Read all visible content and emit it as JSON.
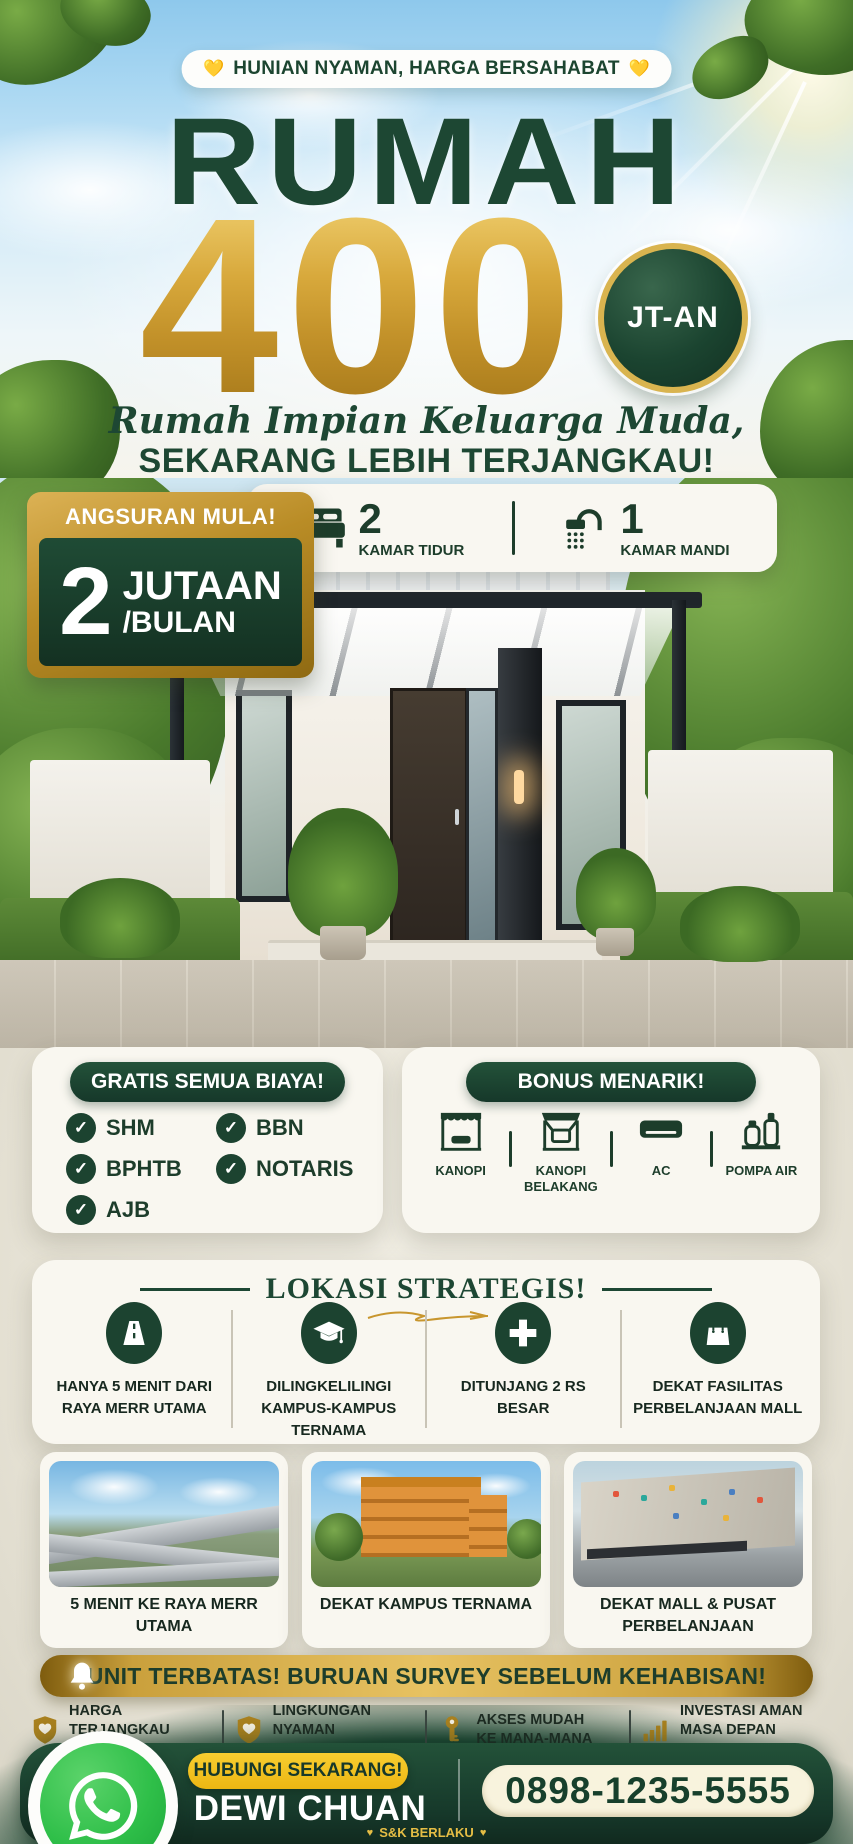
{
  "colors": {
    "dark_green": "#1c4330",
    "gold": "#c8962e",
    "gold_light": "#e7c262",
    "yellow_cta": "#f6c21a",
    "whatsapp_green": "#2fbf49",
    "cream_card": "#f9f7f0",
    "phone_pill": "#f8f3dd"
  },
  "icons": {
    "badge_heart": "💛",
    "terms_heart": "♥"
  },
  "header": {
    "heart": "💛",
    "badge": "HUNIAN NYAMAN, HARGA BERSAHABAT",
    "title": "RUMAH",
    "price": "400",
    "price_badge": "JT-AN",
    "script_line": "Rumah Impian Keluarga Muda,",
    "subline": "SEKARANG LEBIH TERJANGKAU!"
  },
  "installment": {
    "label": "ANGSURAN MULA!",
    "amount": "2",
    "unit": "JUTAAN",
    "per": "/BULAN"
  },
  "specs": {
    "bedrooms": {
      "count": "2",
      "label": "KAMAR TIDUR"
    },
    "bathrooms": {
      "count": "1",
      "label": "KAMAR MANDI"
    }
  },
  "gratis": {
    "title": "GRATIS SEMUA BIAYA!",
    "items": [
      "SHM",
      "BPHTB",
      "AJB",
      "BBN",
      "NOTARIS"
    ]
  },
  "bonus": {
    "title": "BONUS MENARIK!",
    "items": [
      "KANOPI",
      "KANOPI BELAKANG",
      "AC",
      "POMPA AIR"
    ]
  },
  "location": {
    "title": "LOKASI STRATEGIS!",
    "points": [
      "HANYA 5 MENIT DARI RAYA MERR UTAMA",
      "DILINGKELILINGI KAMPUS-KAMPUS TERNAMA",
      "DITUNJANG 2 RS BESAR",
      "DEKAT FASILITAS PERBELANJAAN MALL"
    ],
    "photo_captions": [
      "5 MENIT KE RAYA MERR UTAMA",
      "DEKAT KAMPUS TERNAMA",
      "DEKAT MALL & PUSAT PERBELANJAAN"
    ]
  },
  "banner": {
    "text": "UNIT TERBATAS! BURUAN SURVEY SEBELUM KEHABISAN!"
  },
  "features": [
    {
      "line1": "HARGA TERJANGKAU",
      "line2": "KUALITAS TERBAIK"
    },
    {
      "line1": "LINGKUNGAN NYAMAN",
      "line2": "DAN AMAN"
    },
    {
      "line1": "AKSES MUDAH",
      "line2": "KE MANA-MANA"
    },
    {
      "line1": "INVESTASI AMAN",
      "line2": "MASA DEPAN CERAH"
    }
  ],
  "footer": {
    "cta": "HUBUNGI SEKARANG!",
    "name": "DEWI CHUAN",
    "phone": "0898-1235-5555",
    "terms": "S&K BERLAKU",
    "heart": "♥"
  }
}
